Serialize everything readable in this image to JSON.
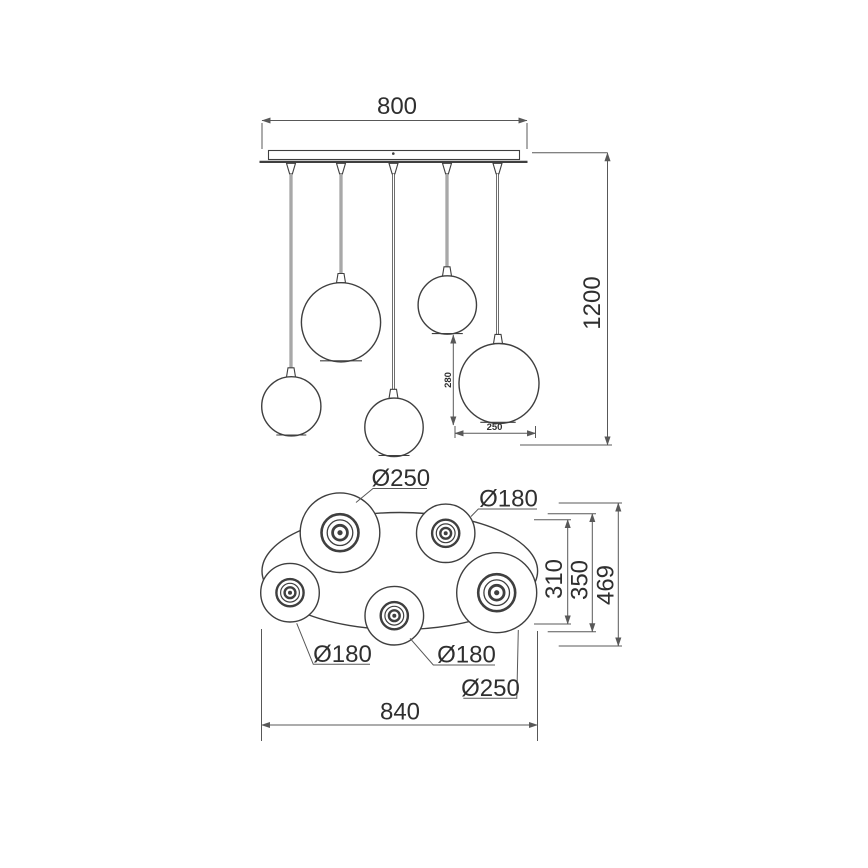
{
  "colors": {
    "line": "#3f3f3f",
    "dimension_line": "#585858",
    "text": "#2f2f2f",
    "background": "#ffffff"
  },
  "side_view": {
    "canopy_width": "800",
    "total_height": "1200",
    "globe_height": "280",
    "globe_width": "250"
  },
  "top_view": {
    "globe_top_left_diameter": "Ø250",
    "globe_top_right_diameter": "Ø180",
    "globe_left_diameter": "Ø180",
    "globe_middle_diameter": "Ø180",
    "globe_right_diameter": "Ø250",
    "overall_width": "840",
    "depth_inner": "310",
    "depth_middle": "350",
    "depth_overall": "469"
  }
}
